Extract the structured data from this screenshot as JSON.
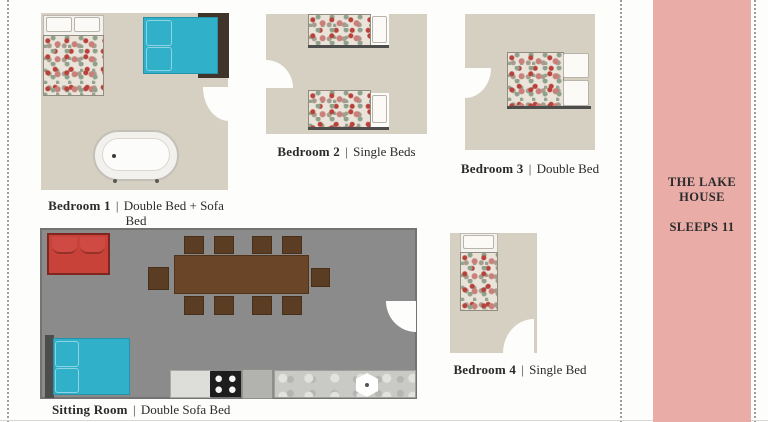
{
  "colors": {
    "background": "#fdfdfb",
    "room_beige": "#d6d0c2",
    "sitting_gray": "#8b8b8b",
    "panel_pink": "#e9aca6",
    "accent_teal": "#31b0c9",
    "sofa_red": "#c8423a",
    "table_brown": "#6b4527",
    "chair_brown": "#5a3d22",
    "text_dark": "#2b2b2b"
  },
  "labels": {
    "separator": "|",
    "bedroom1": {
      "name": "Bedroom 1",
      "description": "Double Bed + Sofa Bed"
    },
    "bedroom2": {
      "name": "Bedroom 2",
      "description": "Single Beds"
    },
    "bedroom3": {
      "name": "Bedroom 3",
      "description": "Double Bed"
    },
    "bedroom4": {
      "name": "Bedroom 4",
      "description": "Single Bed"
    },
    "sitting_room": {
      "name": "Sitting Room",
      "description": "Double Sofa Bed"
    }
  },
  "panel": {
    "title_line1": "THE LAKE",
    "title_line2": "HOUSE",
    "sleeps": "SLEEPS 11"
  }
}
